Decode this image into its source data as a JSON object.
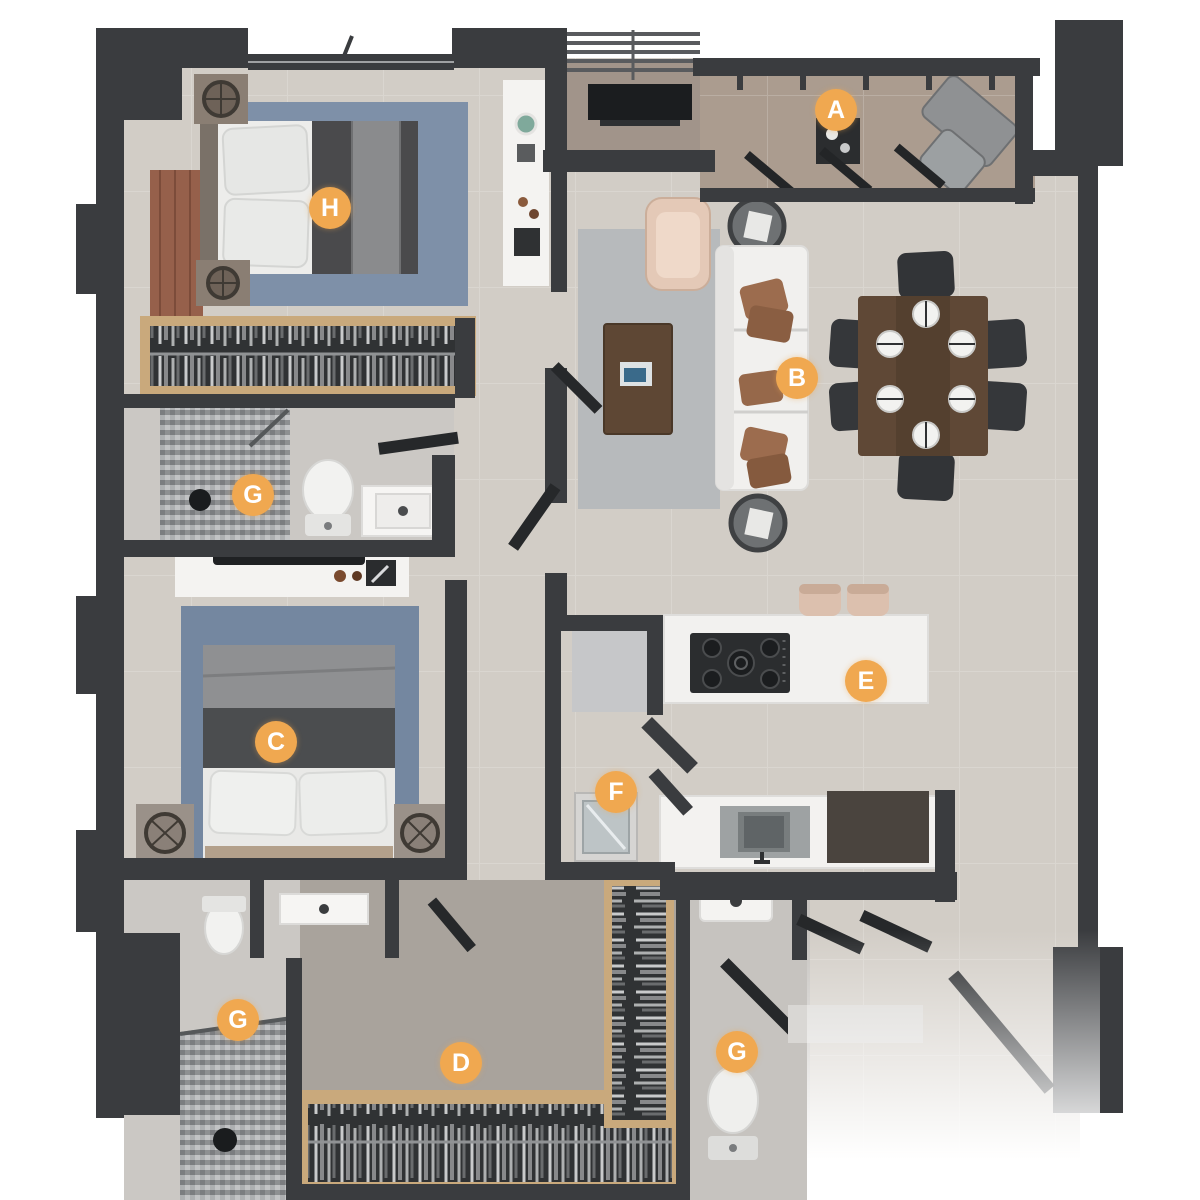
{
  "plan": {
    "type": "apartment-floorplan-3d-top-view",
    "marker_color": "#F0A850",
    "marker_text_color": "#FFFFFF",
    "marker_diameter_px": 42,
    "markers": [
      {
        "letter": "A",
        "x": 836,
        "y": 110,
        "location": "balcony"
      },
      {
        "letter": "B",
        "x": 797,
        "y": 378,
        "location": "living-dining"
      },
      {
        "letter": "C",
        "x": 276,
        "y": 742,
        "location": "second-bedroom"
      },
      {
        "letter": "D",
        "x": 461,
        "y": 1063,
        "location": "dressing-room"
      },
      {
        "letter": "E",
        "x": 866,
        "y": 681,
        "location": "kitchen-island"
      },
      {
        "letter": "F",
        "x": 616,
        "y": 792,
        "location": "utility-room"
      },
      {
        "letter": "G",
        "x": 253,
        "y": 495,
        "location": "bathroom-upper"
      },
      {
        "letter": "G",
        "x": 238,
        "y": 1020,
        "location": "bathroom-lower"
      },
      {
        "letter": "G",
        "x": 737,
        "y": 1052,
        "location": "guest-toilet"
      },
      {
        "letter": "H",
        "x": 330,
        "y": 208,
        "location": "main-bedroom"
      }
    ],
    "colors": {
      "background": "#FFFFFF",
      "wall": "#3A3C3F",
      "floor_main": "#D2CDC6",
      "floor_dressing": "#A9A39C",
      "floor_bath": "#CBC8C4",
      "floor_balcony": "#AB9C8F",
      "rug_living": "#B7BABC",
      "rug_bedroom_main": "#7E90A8",
      "rug_bedroom_second": "#7487A0",
      "wood_light": "#C9A97C",
      "wood_dark": "#5F4836",
      "furniture_white": "#F2F1EF",
      "furniture_dark": "#2E3032",
      "accent_tan": "#E2C7B5"
    }
  }
}
